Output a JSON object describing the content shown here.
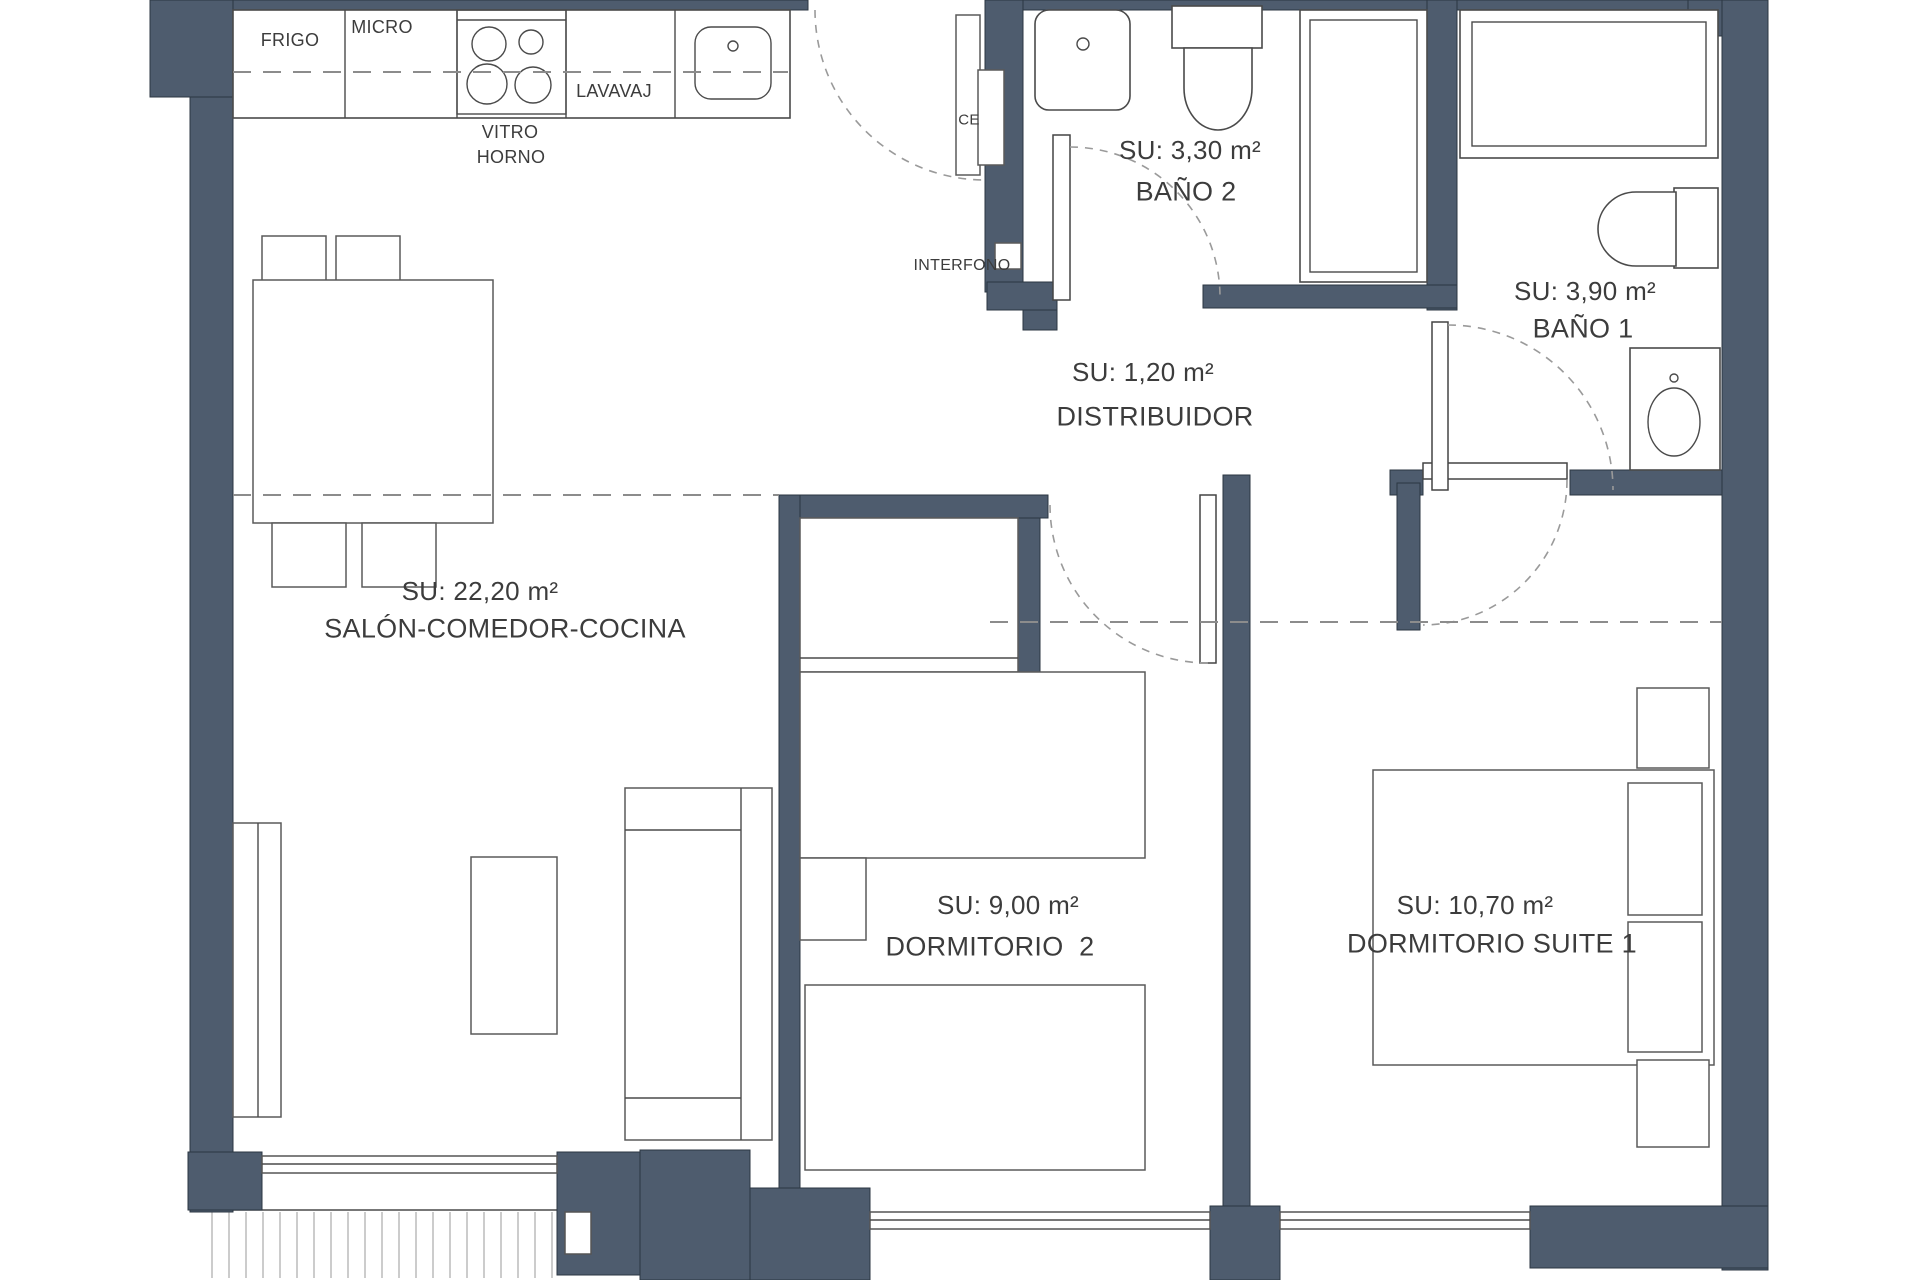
{
  "colors": {
    "wall": "#4e5c6e",
    "line": "#4a4a4a",
    "dash": "#8c8c8c",
    "text": "#3c3c3c"
  },
  "rooms": {
    "salon": {
      "area": "SU: 22,20 m²",
      "name": "SALÓN-COMEDOR-COCINA"
    },
    "dormitorio2": {
      "area": "SU: 9,00 m²",
      "name": "DORMITORIO  2"
    },
    "suite": {
      "area": "SU: 10,70 m²",
      "name": "DORMITORIO SUITE 1"
    },
    "bano2": {
      "area": "SU: 3,30 m²",
      "name": "BAÑO 2"
    },
    "bano1": {
      "area": "SU: 3,90 m²",
      "name": "BAÑO 1"
    },
    "distribuidor": {
      "area": "SU: 1,20 m²",
      "name": "DISTRIBUIDOR"
    }
  },
  "kitchen": {
    "frigo": "FRIGO",
    "micro": "MICRO",
    "lavavaj": "LAVAVAJ",
    "vitro": "VITRO",
    "horno": "HORNO"
  },
  "entry": {
    "ce": "CE",
    "interfono": "INTERFONO"
  }
}
